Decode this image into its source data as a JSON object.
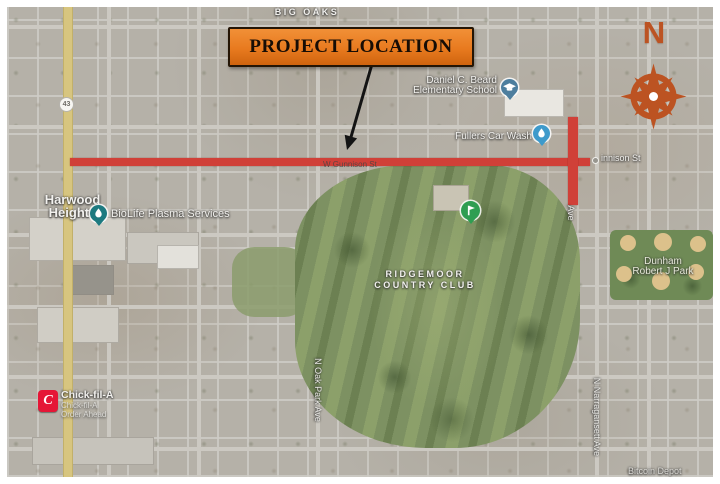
{
  "map": {
    "region_label": "BIG OAKS",
    "banner": {
      "label": "PROJECT LOCATION"
    },
    "compass": {
      "letter": "N"
    },
    "route_shield": "43",
    "streets": {
      "gunnison_center": "W Gunnison St",
      "gunnison_right": "innison St",
      "oak_park": "N Oak Park Ave",
      "narragansett": "N Narragansett Ave",
      "ave_partial": "Ave"
    },
    "places": {
      "harwood": {
        "line1": "Harwood",
        "line2": "Heights"
      },
      "school": {
        "line1": "Daniel C. Beard",
        "line2": "Elementary School"
      },
      "car_wash": "Fullers Car Wash",
      "biolife": "BioLife Plasma Services",
      "ridgemoor": {
        "line1": "RIDGEMOOR",
        "line2": "COUNTRY CLUB"
      },
      "dunham": {
        "line1": "Dunham",
        "line2": "Robert J Park"
      },
      "chickfila": {
        "title": "Chick-fil-A",
        "sub1": "Chick-fil-A",
        "sub2": "Order Ahead",
        "logo_letter": "C"
      },
      "bitcoin": "Bitcoin Depot"
    },
    "colors": {
      "highlight_red": "#D04038",
      "banner_orange": "#E8761F",
      "compass_orange": "#BC5322",
      "golf_pin_green": "#2F9E52",
      "school_icon_blue": "#4D7E9E",
      "carwash_icon_blue": "#3E9ACB",
      "biolife_icon_teal": "#1D7A80",
      "chickfila_red": "#E51636",
      "harlem_road_yellow": "#D7C57F"
    }
  }
}
